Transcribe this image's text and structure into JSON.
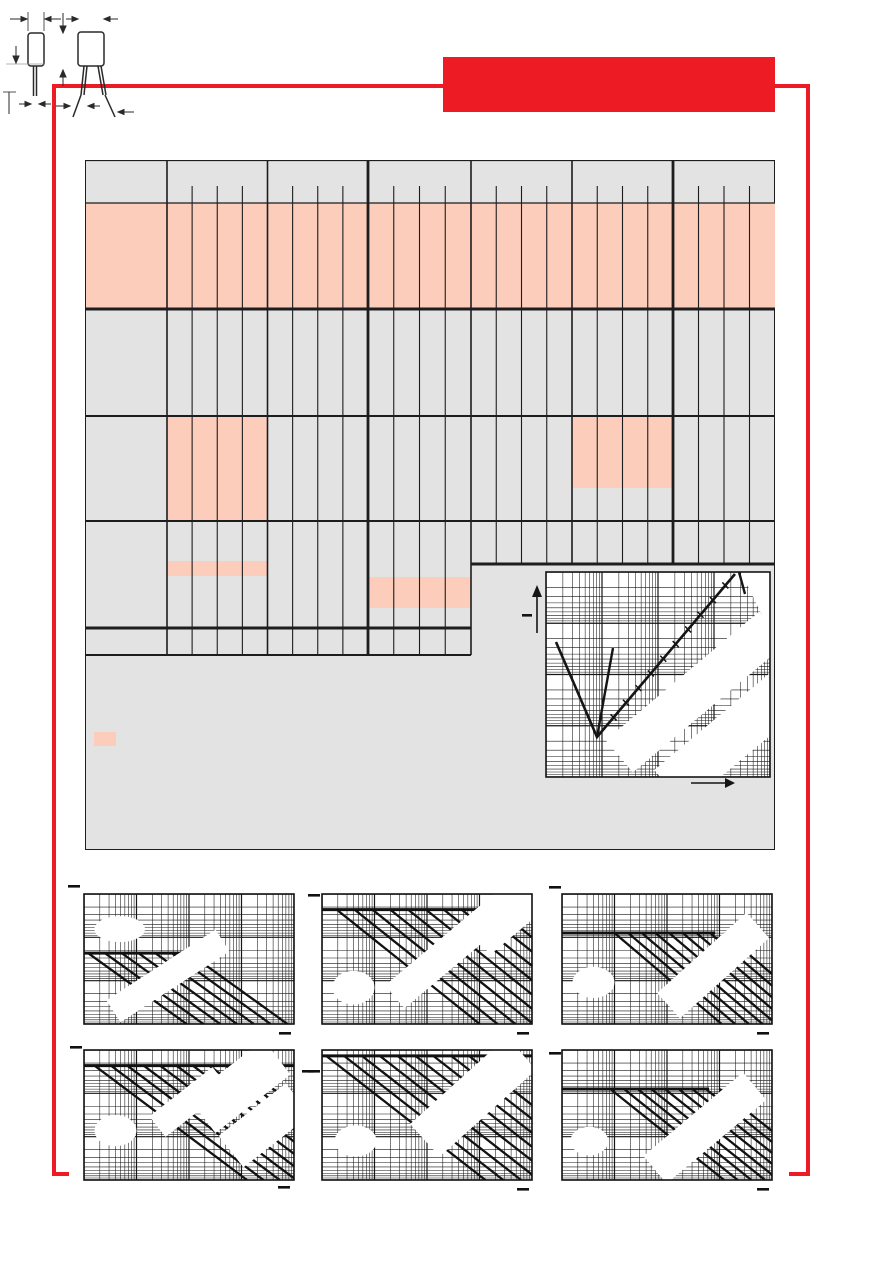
{
  "document": {
    "kind": "capacitor-datasheet-page-skeleton",
    "visible_text": "",
    "notes": "All labels/values are blanked in the scan; only table grid, highlight blocks, dimension drawing and log-log chart line art are visible."
  },
  "colors": {
    "accent_red": "#ED1C24",
    "highlight_salmon": "#FBCDBA",
    "panel_grey": "#E3E3E3",
    "line_black": "#1D1D1F",
    "page_white": "#FFFFFF"
  },
  "header_banner": {
    "text": "",
    "x": 443,
    "y": 57,
    "w": 332,
    "h": 55
  },
  "frame": {
    "top": {
      "x": 52,
      "y": 84,
      "w": 758,
      "h": 4
    },
    "left": {
      "x": 52,
      "y": 84,
      "w": 4,
      "h": 1092
    },
    "left_foot": {
      "x": 52,
      "y": 1172,
      "w": 17,
      "h": 4
    },
    "right": {
      "x": 806,
      "y": 84,
      "w": 4,
      "h": 1092
    },
    "right_foot": {
      "x": 789,
      "y": 1172,
      "w": 21,
      "h": 4
    }
  },
  "panel": {
    "x": 85,
    "y": 160,
    "w": 690,
    "h": 690
  },
  "table": {
    "x": 85,
    "y": 160,
    "w": 690,
    "label_col_w": 82,
    "groups_local": [
      82,
      182.5,
      283,
      386,
      487,
      588,
      690
    ],
    "thick_groups_local": [
      283,
      588
    ],
    "header_tick_top": 26,
    "left_half_end_local": 386,
    "left_bottom_local": 495,
    "right_bottom_local": 404,
    "h_lines": [
      {
        "y": 0,
        "x1": 0,
        "x2": 690,
        "w": 2.2
      },
      {
        "y": 43,
        "x1": 0,
        "x2": 690,
        "w": 1.2
      },
      {
        "y": 149,
        "x1": 0,
        "x2": 690,
        "w": 3
      },
      {
        "y": 256,
        "x1": 0,
        "x2": 690,
        "w": 2
      },
      {
        "y": 361,
        "x1": 0,
        "x2": 690,
        "w": 2
      },
      {
        "y": 404,
        "x1": 386,
        "x2": 690,
        "w": 3
      },
      {
        "y": 468,
        "x1": 0,
        "x2": 386,
        "w": 3
      },
      {
        "y": 495,
        "x1": 0,
        "x2": 386,
        "w": 2
      }
    ],
    "highlights": [
      {
        "x": 0,
        "y": 43,
        "w": 690,
        "h": 106
      },
      {
        "x": 82,
        "y": 256,
        "w": 100.5,
        "h": 105
      },
      {
        "x": 487,
        "y": 256,
        "w": 101,
        "h": 72
      },
      {
        "x": 82,
        "y": 401,
        "w": 100.5,
        "h": 15
      },
      {
        "x": 283,
        "y": 417,
        "w": 103,
        "h": 31
      }
    ]
  },
  "legend_swatch": {
    "x": 94,
    "y": 732,
    "w": 22,
    "h": 14
  },
  "dimension_drawing": {
    "x": 395,
    "y": 690,
    "w": 160,
    "h": 130,
    "views": [
      "capacitor-side-view",
      "capacitor-front-view"
    ]
  },
  "chart_data": [
    {
      "id": "impedance-vs-frequency",
      "type": "line",
      "title": "",
      "x_scale": "log",
      "y_scale": "log",
      "x_decades": 4,
      "y_decades": 4,
      "axis_tick_labels": [],
      "legend": "none (labels erased)",
      "series": [
        {
          "name": "impedance-V-curve",
          "shape": "falls to resonance minimum then rises"
        },
        {
          "name": "esr-branch",
          "shape": "steep rising fork from minimum"
        }
      ],
      "svg_box": {
        "x": 520,
        "y": 565,
        "w": 262,
        "h": 235
      },
      "plot": {
        "x": 26,
        "y": 7,
        "w": 224,
        "h": 205
      }
    },
    {
      "id": "derating-chart-1",
      "type": "line",
      "title": "",
      "x_scale": "log",
      "y_scale": "log",
      "x_decades": 4,
      "y_decades": 3,
      "axis_tick_labels": [],
      "series": [
        {
          "name": "rated-voltage-plateau"
        },
        {
          "name": "derating-diagonals",
          "count": 7
        }
      ],
      "box": {
        "x": 64,
        "y": 880
      },
      "render": {
        "plateau": 0.455,
        "plateau_end": 0.5,
        "diag_count": 7,
        "diag_x0": 0.02,
        "diag_dx": 0.08,
        "slope": 0.72,
        "blob": [
          0.17,
          0.27,
          0.12,
          0.1
        ],
        "bands": [
          [
            0.4,
            0.63,
            130,
            26,
            -33
          ]
        ]
      },
      "marks": [
        [
          -16,
          -9
        ],
        [
          195,
          138
        ]
      ]
    },
    {
      "id": "derating-chart-2",
      "type": "line",
      "title": "",
      "x_scale": "log",
      "y_scale": "log",
      "x_decades": 4,
      "y_decades": 3,
      "axis_tick_labels": [],
      "series": [
        {
          "name": "rated-voltage-plateau"
        },
        {
          "name": "derating-diagonals",
          "count": 10
        }
      ],
      "box": {
        "x": 302,
        "y": 880
      },
      "render": {
        "plateau": 0.12,
        "plateau_end": 1.0,
        "diag_count": 10,
        "diag_x0": 0.07,
        "diag_dx": 0.085,
        "slope": 0.8,
        "blob": [
          0.15,
          0.72,
          0.1,
          0.13
        ],
        "bands": [
          [
            0.62,
            0.42,
            150,
            30,
            -40
          ],
          [
            0.88,
            0.14,
            80,
            44,
            -40
          ]
        ]
      },
      "marks": [
        [
          -14,
          0
        ],
        [
          195,
          138
        ]
      ]
    },
    {
      "id": "derating-chart-3",
      "type": "line",
      "title": "",
      "x_scale": "log",
      "y_scale": "log",
      "x_decades": 4,
      "y_decades": 3,
      "axis_tick_labels": [],
      "series": [
        {
          "name": "rated-voltage-plateau"
        },
        {
          "name": "derating-diagonals",
          "count": 9
        }
      ],
      "box": {
        "x": 542,
        "y": 880
      },
      "render": {
        "plateau": 0.3,
        "plateau_end": 0.73,
        "diag_count": 9,
        "diag_x0": 0.25,
        "diag_dx": 0.065,
        "slope": 0.85,
        "blob": [
          0.15,
          0.68,
          0.1,
          0.12
        ],
        "bands": [
          [
            0.72,
            0.55,
            120,
            34,
            -42
          ]
        ]
      },
      "marks": [
        [
          -13,
          -8
        ],
        [
          195,
          138
        ]
      ]
    },
    {
      "id": "derating-chart-4",
      "type": "line",
      "title": "",
      "x_scale": "log",
      "y_scale": "log",
      "x_decades": 4,
      "y_decades": 3,
      "axis_tick_labels": [],
      "series": [
        {
          "name": "rated-voltage-plateau"
        },
        {
          "name": "derating-diagonals",
          "count": 10
        }
      ],
      "box": {
        "x": 64,
        "y": 1036
      },
      "render": {
        "plateau": 0.12,
        "plateau_end": 1.0,
        "diag_count": 10,
        "diag_x0": 0.05,
        "diag_dx": 0.078,
        "slope": 0.75,
        "blob": [
          0.15,
          0.62,
          0.1,
          0.12
        ],
        "bands": [
          [
            0.5,
            0.4,
            80,
            26,
            -38
          ],
          [
            0.74,
            0.28,
            95,
            44,
            -38
          ],
          [
            0.86,
            0.58,
            85,
            40,
            -38
          ]
        ]
      },
      "marks": [
        [
          -14,
          -4
        ],
        [
          218,
          20
        ],
        [
          194,
          136
        ]
      ]
    },
    {
      "id": "derating-chart-5",
      "type": "line",
      "title": "",
      "x_scale": "log",
      "y_scale": "log",
      "x_decades": 4,
      "y_decades": 3,
      "axis_tick_labels": [],
      "series": [
        {
          "name": "rated-voltage-plateau"
        },
        {
          "name": "derating-diagonals",
          "count": 9
        }
      ],
      "box": {
        "x": 302,
        "y": 1036
      },
      "render": {
        "plateau": 0.045,
        "plateau_end": 1.0,
        "diag_count": 9,
        "diag_x0": 0.02,
        "diag_dx": 0.085,
        "slope": 0.78,
        "blob": [
          0.16,
          0.7,
          0.1,
          0.12
        ],
        "bands": [
          [
            0.72,
            0.36,
            130,
            44,
            -42
          ]
        ]
      },
      "marks": [
        [
          -14,
          20
        ],
        [
          195,
          138
        ]
      ]
    },
    {
      "id": "derating-chart-6",
      "type": "line",
      "title": "",
      "x_scale": "log",
      "y_scale": "log",
      "x_decades": 4,
      "y_decades": 3,
      "axis_tick_labels": [],
      "series": [
        {
          "name": "rated-voltage-plateau"
        },
        {
          "name": "derating-diagonals",
          "count": 9
        }
      ],
      "box": {
        "x": 542,
        "y": 1036
      },
      "render": {
        "plateau": 0.3,
        "plateau_end": 0.7,
        "diag_count": 9,
        "diag_x0": 0.23,
        "diag_dx": 0.065,
        "slope": 0.8,
        "blob": [
          0.13,
          0.7,
          0.09,
          0.11
        ],
        "bands": [
          [
            0.68,
            0.6,
            130,
            36,
            -40
          ]
        ]
      },
      "marks": [
        [
          -13,
          2
        ],
        [
          195,
          138
        ]
      ]
    }
  ]
}
